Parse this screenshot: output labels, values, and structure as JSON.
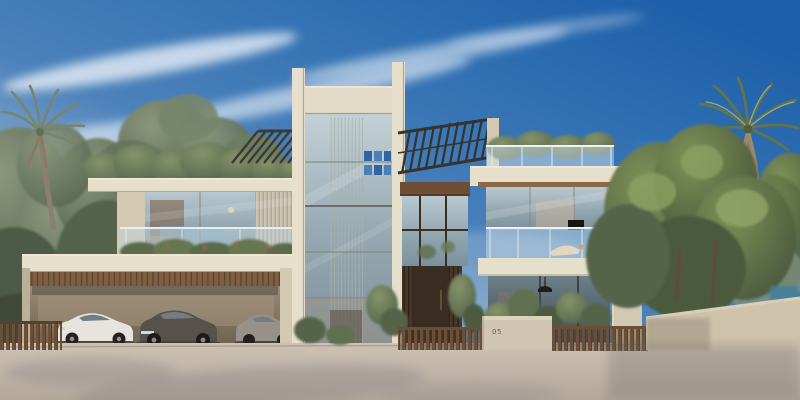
{
  "meta": {
    "description": "Photorealistic architectural exterior rendering of a modern two-storey luxury villa at daytime: central glass stair tower between beige concrete columns, slatted roof pergolas, roof garden, glass-balustrade balconies, timber-lined triple carport with three parked cars, bronze entrance door, stone street walls and wooden fences, palm trees left and right under a blue sky with wispy clouds"
  },
  "house": {
    "number": "05"
  },
  "scene": {
    "sky": "clear blue, deeper at top right, pale haze at left horizon, wispy cirrus clouds upper left",
    "vehicles": [
      {
        "label": "white sedan",
        "color": "#e7e4df"
      },
      {
        "label": "dark grey sedan",
        "color": "#56514b"
      },
      {
        "label": "silver sedan",
        "color": "#98918a"
      }
    ],
    "vegetation": [
      "left palm tree",
      "right palm tree",
      "roof garden shrubs",
      "balcony planter flowers",
      "entrance hedges",
      "background trees left",
      "background trees right"
    ],
    "architecture": [
      "central glass stair tower",
      "blue wall artworks inside tower",
      "angled slatted pergolas",
      "glass balustrade balconies",
      "roof terrace",
      "timber soffit carport",
      "bronze entrance door",
      "street wall with house number",
      "wooden slat fences"
    ]
  },
  "colors": {
    "sky-deep": "#1d5fa9",
    "sky-mid": "#4d82bb",
    "sky-pale": "#d8dcd6",
    "concrete-light": "#e6dfcc",
    "concrete-mid": "#d3c8b2",
    "concrete-shade": "#bdb098",
    "wood": "#6e4f36",
    "bronze": "#3a2d22",
    "glass-tint": "#a9bcc4",
    "foliage-dark": "#46543b",
    "foliage-mid": "#5f7050",
    "foliage-light": "#8ba061",
    "road": "#c6bbac",
    "artwork-blue": "#2f64a5"
  }
}
